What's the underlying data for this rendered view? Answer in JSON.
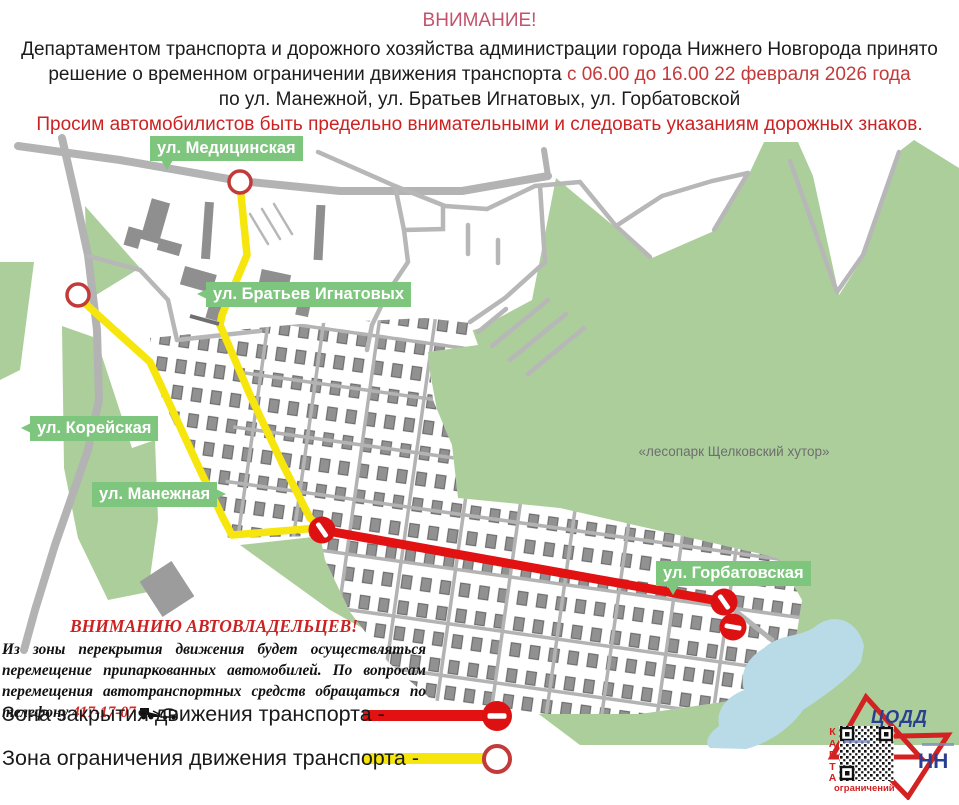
{
  "header": {
    "attention": "ВНИМАНИЕ!",
    "decision_text": "Департаментом транспорта и дорожного хозяйства администрации города Нижнего Новгорода принято решение о временном ограничении движения транспорта ",
    "decision_dates": "с 06.00 до 16.00 22 февраля 2026 года",
    "streets_line": "по ул. Манежной, ул. Братьев Игнатовых, ул. Горбатовской",
    "warning_line": "Просим автомобилистов быть предельно внимательными и следовать указаниям дорожных знаков."
  },
  "map": {
    "labels": {
      "medicinskaya": "ул. Медицинская",
      "bratyev_ignatovykh": "ул. Братьев Игнатовых",
      "koreyskaya": "ул. Корейская",
      "manezhnaya": "ул. Манежная",
      "gorbatovskaya": "ул. Горбатовская"
    },
    "forest_label": "«лесопарк Щелковский хутор»",
    "colors": {
      "closure_line": "#e21212",
      "restriction_line": "#f6e60e",
      "forest_green": "#abce9b",
      "label_green": "#7ec57e",
      "road_gray": "#b3b3b3",
      "pond_blue": "#b9dbe7"
    }
  },
  "notice": {
    "title": "ВНИМАНИЮ АВТОВЛАДЕЛЬЦЕВ!",
    "body": "Из зоны перекрытия движения будет осуществляться перемещение припаркованных автомобилей. По вопросам перемещения автотранспортных средств обращаться по телефону ",
    "phone": "417-17-07"
  },
  "legend": {
    "closure": "Зона закрытия движения транспорта -",
    "restriction": "Зона ограничения движения транспорта -"
  },
  "logo": {
    "org": "ЦОДД",
    "city": "НН",
    "qr_side": "КАРТА",
    "qr_caption": "ограничений"
  }
}
